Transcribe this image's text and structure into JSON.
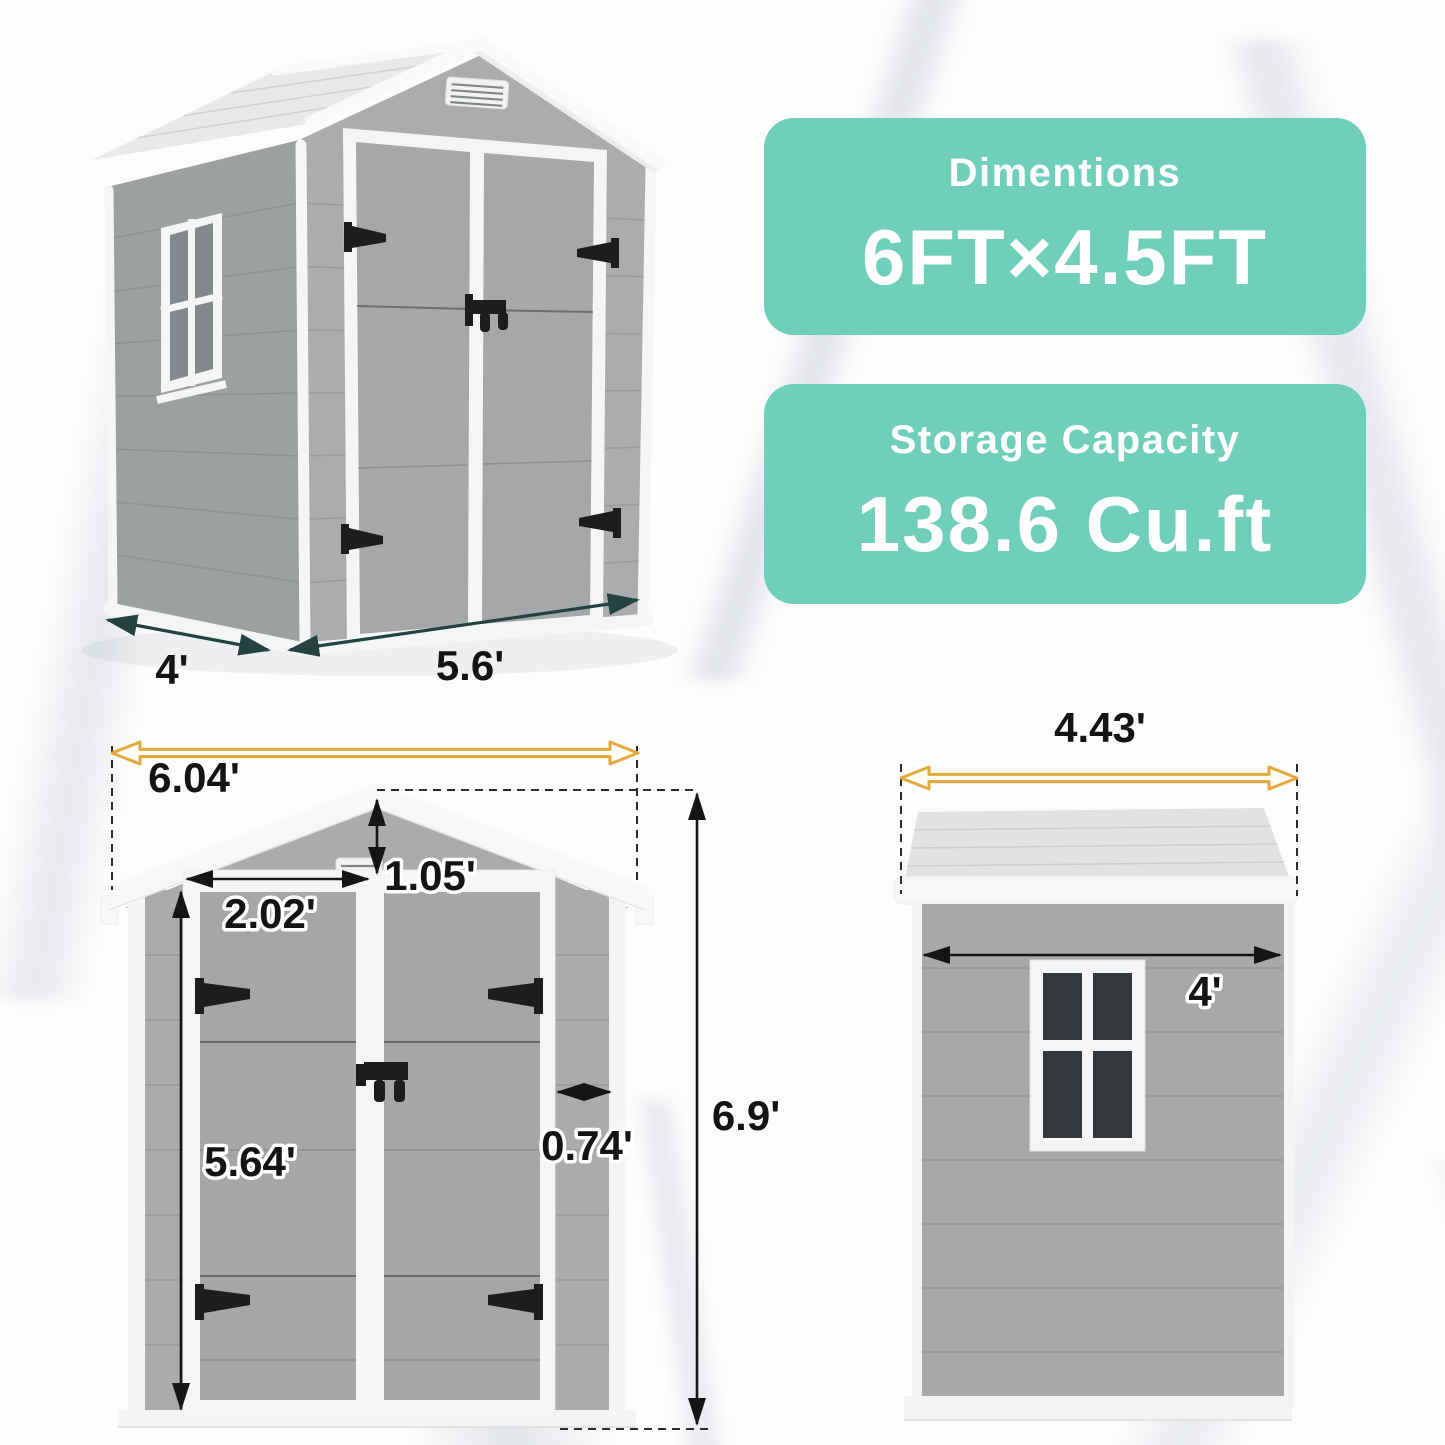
{
  "cards": {
    "dimensions": {
      "title": "Dimentions",
      "value": "6FT×4.5FT"
    },
    "capacity": {
      "title": "Storage Capacity",
      "value": "138.6 Cu.ft"
    }
  },
  "perspective_view": {
    "depth": "4'",
    "width": "5.6'"
  },
  "front_view": {
    "overall_width": "6.04'",
    "gable_height": "1.05'",
    "door_width": "2.02'",
    "door_height": "5.64'",
    "side_panel": "0.74'",
    "overall_height": "6.9'"
  },
  "side_view": {
    "roof_depth": "4.43'",
    "wall_depth": "4'"
  },
  "colors": {
    "teal_card": "#6fcfba",
    "yellow_arrow": "#e2a93e",
    "dark_teal_arrow": "#24423f",
    "dimension_text": "#141414",
    "shed_gray": "#a9abac",
    "trim_white": "#f4f5f5"
  }
}
